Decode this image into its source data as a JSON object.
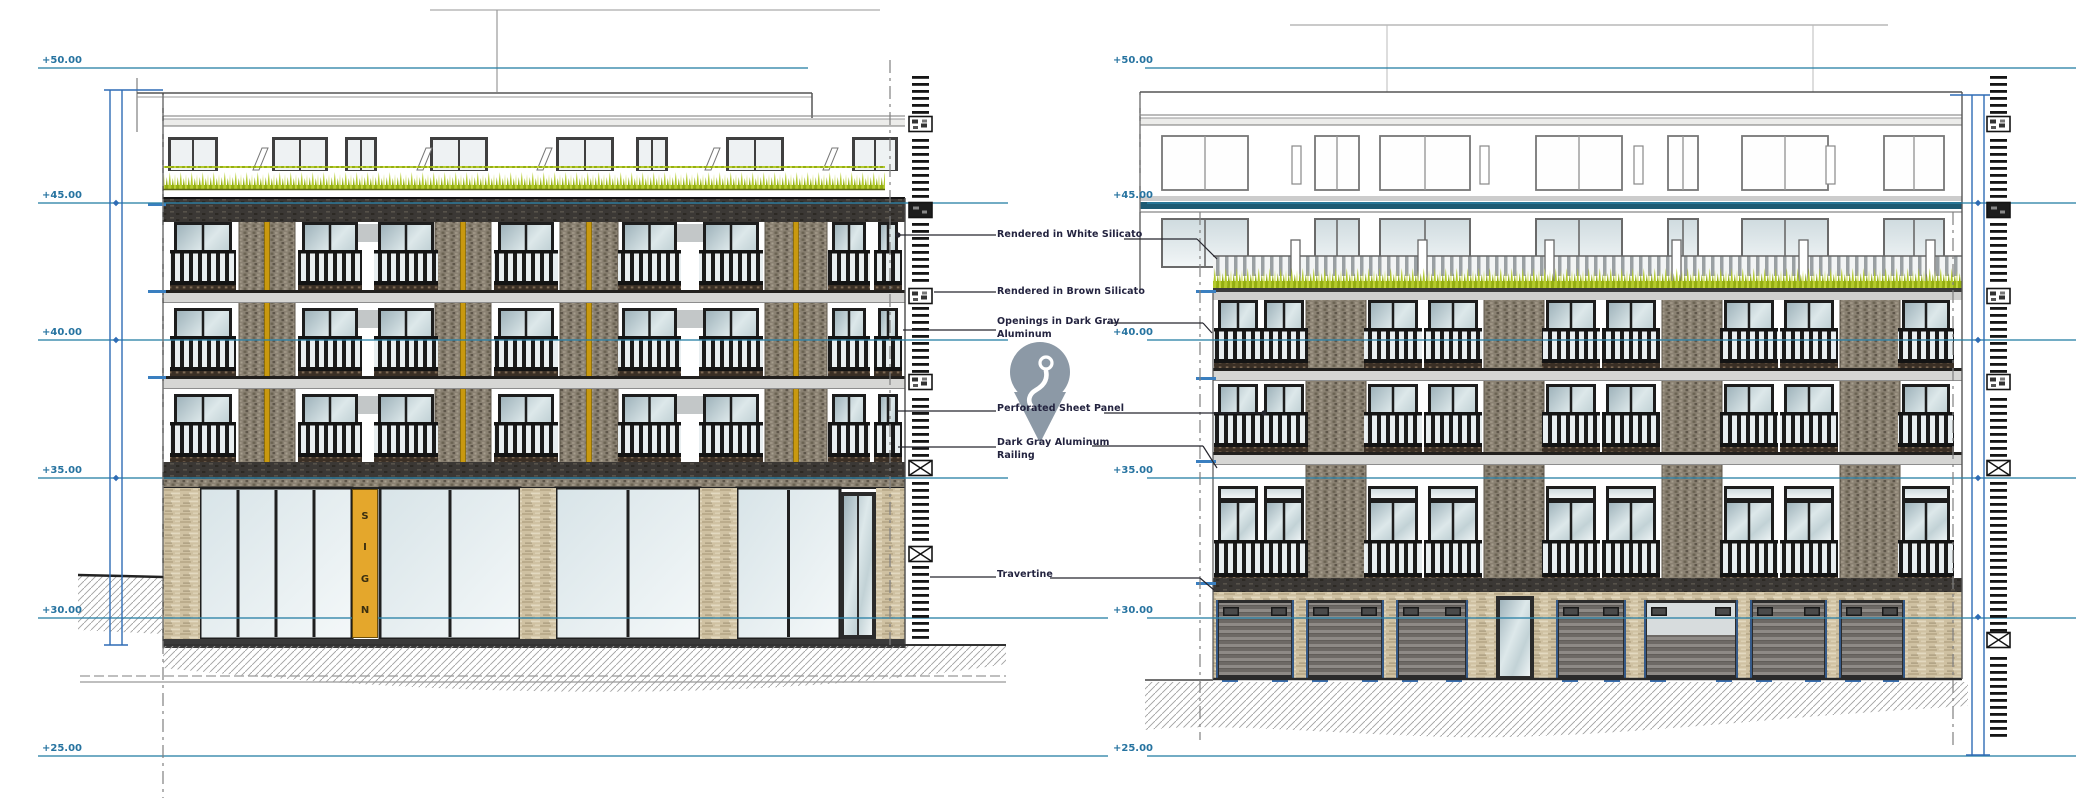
{
  "title": "Building elevations - street facades",
  "colors": {
    "teal": "#2e83a8",
    "teal_dark": "#1d5a72",
    "blue": "#2f6cb5",
    "ink": "#23233f",
    "leader": "#26262e",
    "line_gray": "#555555",
    "grass": "#b4ca2d",
    "grass_dark": "#93ad12",
    "grass_light": "#c6d63e",
    "brick": "#8a8172",
    "travertine": "#cfc1a2",
    "gold": "#c9990f",
    "sign_bg": "#e4a72c",
    "dark_band": "#3b3835",
    "frame": "#1d1d1d",
    "pin": "#8c99a6",
    "hatch": "#a0a0a0",
    "garage_slat": "#6d6965"
  },
  "levels": [
    {
      "label": "+50.00",
      "y": 68
    },
    {
      "label": "+45.00",
      "y": 203
    },
    {
      "label": "+40.00",
      "y": 340
    },
    {
      "label": "+35.00",
      "y": 478
    },
    {
      "label": "+30.00",
      "y": 618
    },
    {
      "label": "+25.00",
      "y": 756
    }
  ],
  "annotations": [
    {
      "text": "Rendered in White Silicato"
    },
    {
      "text": "Rendered in Brown Silicato"
    },
    {
      "text": "Openings in Dark Gray\nAluminum"
    },
    {
      "text": "Perforated Sheet Panel"
    },
    {
      "text": "Dark Gray Aluminum\nRailing"
    },
    {
      "text": "Travertine"
    }
  ],
  "sign": {
    "letters": [
      "S",
      "I",
      "G",
      "N"
    ]
  },
  "icons": {
    "pin": "location-pin-icon"
  }
}
